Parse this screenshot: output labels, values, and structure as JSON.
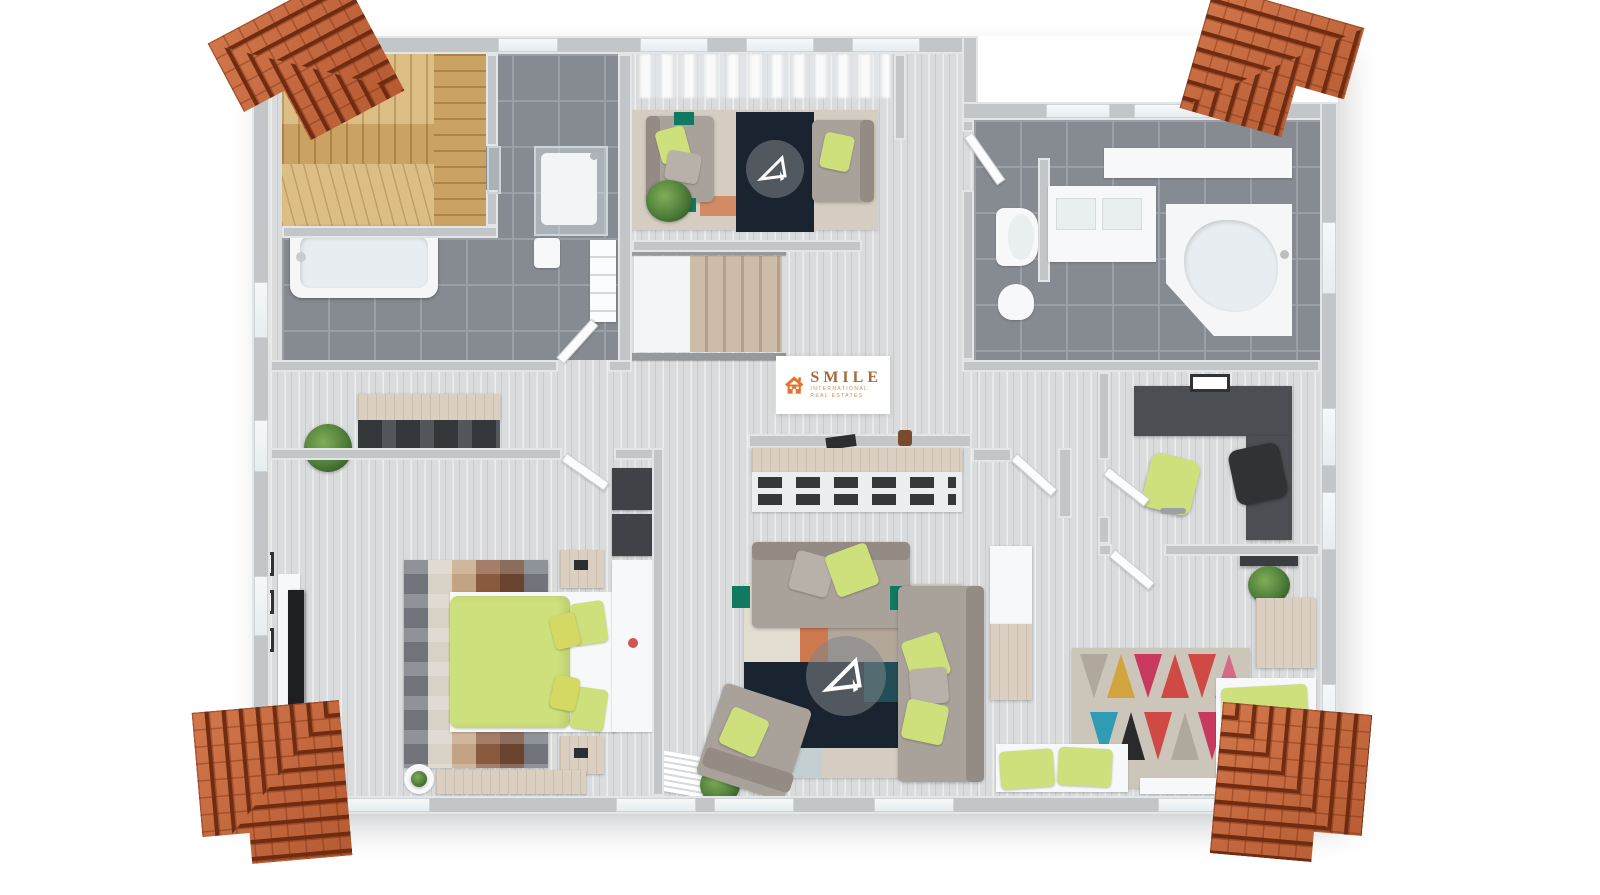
{
  "page": {
    "background": "#ffffff",
    "kind": "3d-floor-plan-render",
    "width": 1600,
    "height": 895
  },
  "logo": {
    "name": "SMILE",
    "tagline_line1": "INTERNATIONAL",
    "tagline_line2": "REAL ESTATES",
    "icon": "house-icon"
  },
  "watermarks": {
    "icon": "sail-boat-watermark",
    "count": 2,
    "locations": [
      "lounge-rug",
      "living-room-rug"
    ]
  },
  "roof_corners": {
    "count": 4,
    "positions": [
      "top-left",
      "top-right",
      "bottom-left",
      "bottom-right"
    ],
    "material": "terracotta-tiles"
  },
  "rooms": [
    {
      "id": "sauna",
      "features": [
        "tiered-wood-benches",
        "glass-door"
      ]
    },
    {
      "id": "bathroom-left",
      "features": [
        "bathtub",
        "shower-cabin",
        "drawer-cabinet",
        "dark-tile-floor"
      ]
    },
    {
      "id": "lounge-top",
      "features": [
        "armchair-left",
        "armchair-right",
        "navy-rug",
        "sail-watermark",
        "potted-plant",
        "emerald-side-tables",
        "sheer-curtains"
      ]
    },
    {
      "id": "staircase",
      "features": [
        "gray-railings",
        "beige-steps"
      ]
    },
    {
      "id": "bathroom-right",
      "features": [
        "toilet",
        "bidet",
        "double-sink-vanity",
        "corner-bathtub",
        "dark-tile-floor",
        "wall-counter"
      ]
    },
    {
      "id": "office",
      "features": [
        "l-shaped-dark-desk",
        "black-office-chair",
        "lime-desk-chair",
        "wall-frame",
        "potted-plant"
      ]
    },
    {
      "id": "master-bedroom",
      "features": [
        "double-bed-lime-duvet",
        "chevron-rug",
        "two-nightstands",
        "tv-panel",
        "three-wall-frames",
        "wardrobe-units",
        "foot-bench",
        "stool",
        "potted-plant"
      ]
    },
    {
      "id": "living-room",
      "features": [
        "sofa-top",
        "sofa-right",
        "armchair",
        "patchwork-rug",
        "sail-watermark",
        "bookshelf-sideboard",
        "emerald-side-tables",
        "lime-pillows"
      ]
    },
    {
      "id": "kids-room",
      "features": [
        "triangle-pattern-rug",
        "daybed-lime-cushions",
        "window-bench-lime-cushions",
        "wardrobe",
        "wall-tv",
        "potted-plant",
        "white-table"
      ]
    },
    {
      "id": "hallway",
      "features": [
        "sideboard-with-books",
        "potted-plant",
        "magazine-rack"
      ]
    }
  ],
  "colors": {
    "wall": "#c3c6c8",
    "floor": "#d9dbdd",
    "floor_line": "#c9ccce",
    "tile": "#868b91",
    "tile_line": "#9aa0a5",
    "sauna_a": "#dcbd84",
    "sauna_b": "#caa263",
    "roof_base": "#c4653c",
    "roof_ridge": "#6f2c10",
    "stairs_a": "#cdbca7",
    "stairs_b": "#b5a189",
    "sofa": "#a9a29a",
    "sofa_dark": "#948c84",
    "lime": "#cde07c",
    "chartreuse": "#d3d962",
    "navy": "#1a2430",
    "emerald": "#0f7a60",
    "desk": "#4b4e52",
    "wood_light": "#dacfc0",
    "white_furn": "#f7f8f9",
    "plant": "#4e7d3a",
    "plant_dark": "#2f5423",
    "rug_base": "#d5cdc1",
    "rug_cream": "#e3dcd1",
    "rug_orange": "#cf7a4e",
    "rug_taupe": "#b3a79a",
    "rug_blue": "#c3cfd0",
    "kids_rug": "#ccc5b9",
    "t_red": "#d04a45",
    "t_crimson": "#c73a5e",
    "t_teal": "#2f9cb3",
    "t_black": "#2b2b2e",
    "t_mustard": "#d2a43e",
    "t_pink": "#d46a84",
    "t_taupe": "#b0a89c",
    "logo_name": "#a96a38",
    "logo_tag": "#cf8c4e",
    "logo_icon": "#e2732c"
  }
}
